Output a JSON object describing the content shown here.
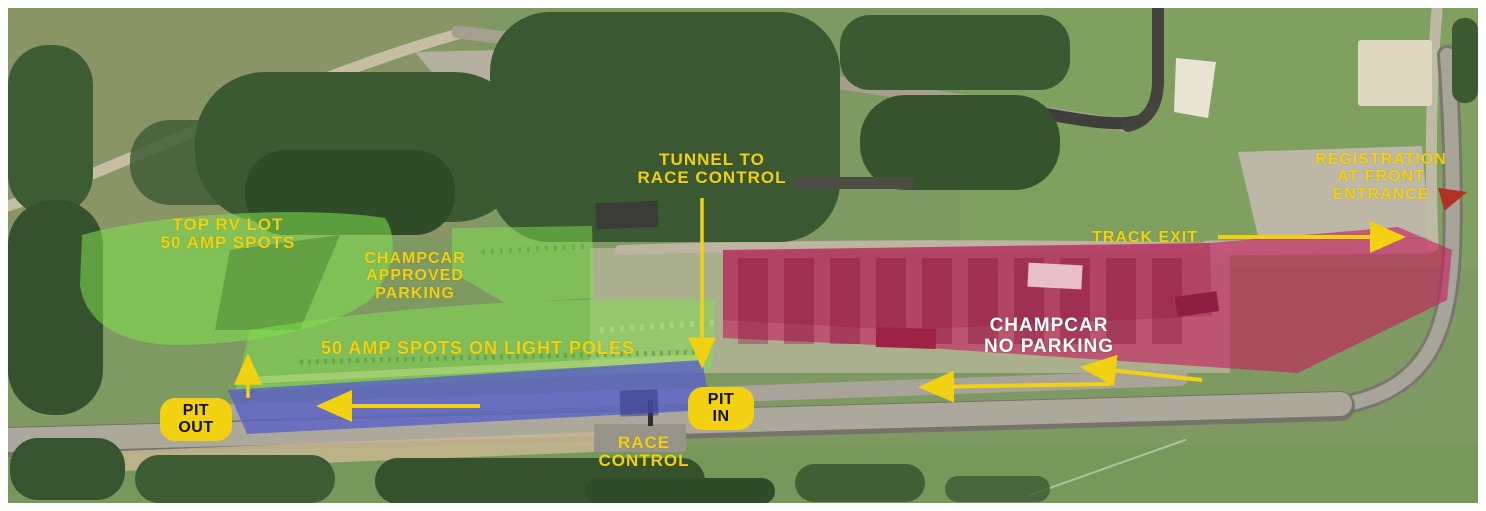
{
  "labels": {
    "top_rv_lot": {
      "line1": "TOP RV LOT",
      "line2": "50 AMP SPOTS"
    },
    "champcar_approved": {
      "line1": "CHAMPCAR",
      "line2": "APPROVED",
      "line3": "PARKING"
    },
    "tunnel": {
      "line1": "TUNNEL TO",
      "line2": "RACE CONTROL"
    },
    "registration": {
      "line1": "REGISTRATION",
      "line2": "AT FRONT",
      "line3": "ENTRANCE"
    },
    "track_exit": "TRACK EXIT",
    "amp_spots_light_poles": "50 AMP SPOTS ON LIGHT POLES",
    "no_parking": {
      "line1": "CHAMPCAR",
      "line2": "NO PARKING"
    },
    "race_control": {
      "line1": "RACE",
      "line2": "CONTROL"
    },
    "pit_out": {
      "line1": "PIT",
      "line2": "OUT"
    },
    "pit_in": {
      "line1": "PIT",
      "line2": "IN"
    }
  },
  "zones": {
    "approved_parking_zone": "CHAMPCAR APPROVED PARKING",
    "no_parking_zone": "CHAMPCAR NO PARKING",
    "pit_lane_zone": "PIT LANE (PIT OUT to PIT IN)"
  },
  "colors": {
    "annotation_yellow": "#F1D111",
    "label_white": "#FFFFFF",
    "badge_text_black": "#111111",
    "zone_green": "#7FE24E",
    "pit_lane_purple": "#5A60C8",
    "zone_red": "#C81A5C",
    "mini_arrow_red": "#B03226"
  }
}
